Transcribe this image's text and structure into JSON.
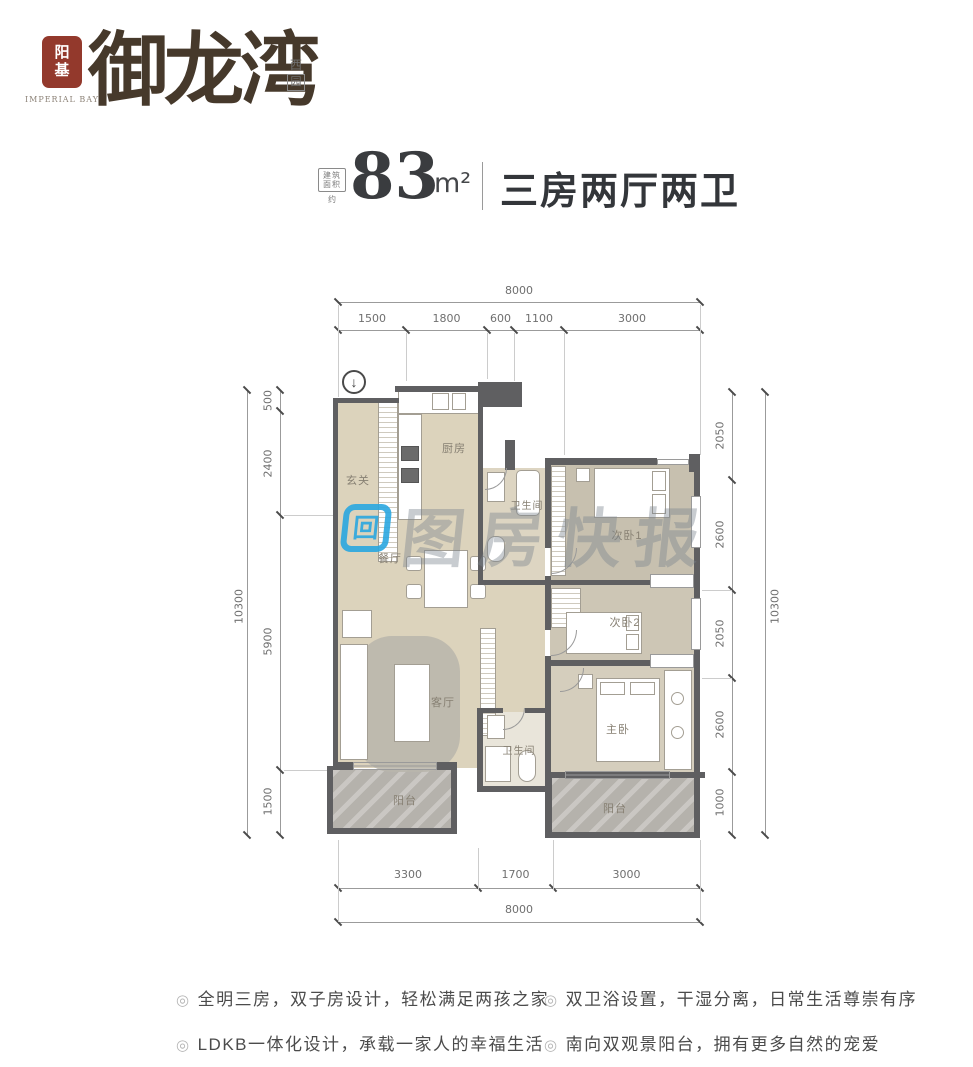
{
  "brand": {
    "seal": "阳基",
    "seal_caption": "IMPERIAL BAY",
    "name": "御龙湾",
    "badge_top": "西",
    "badge_bottom": "园"
  },
  "title": {
    "stamp_line1": "建筑",
    "stamp_line2": "面积",
    "stamp_line3": "约",
    "area": "83",
    "unit": "m²",
    "layout": "三房两厅两卫"
  },
  "plan": {
    "north": "↓",
    "rooms": {
      "hallway": "玄关",
      "kitchen": "厨房",
      "bath1": "卫生间",
      "dining": "餐厅",
      "living": "客厅",
      "bed1": "次卧1",
      "bed2": "次卧2",
      "master": "主卧",
      "bath2": "卫生间",
      "balcony1": "阳台",
      "balcony2": "阳台"
    },
    "dims": {
      "top_total": "8000",
      "top_segments": [
        "1500",
        "1800",
        "600",
        "1100",
        "3000"
      ],
      "left_total": "10300",
      "left_segments": [
        "500",
        "2400",
        "5900",
        "1500"
      ],
      "right_total": "10300",
      "right_segments": [
        "2050",
        "2600",
        "2050",
        "2600",
        "1000"
      ],
      "bottom_segments": [
        "3300",
        "1700",
        "3000"
      ],
      "bottom_total": "8000"
    }
  },
  "watermark": {
    "logo_glyph": "回",
    "text": "图房快报"
  },
  "features": {
    "bullet": "◎",
    "items": [
      "全明三房，双子房设计，轻松满足两孩之家",
      "双卫浴设置，干湿分离，日常生活尊崇有序",
      "LDKB一体化设计，承载一家人的幸福生活",
      "南向双观景阳台，拥有更多自然的宠爱"
    ]
  },
  "colors": {
    "wall": "#5f5f61",
    "floor_beige": "#dcd3bc",
    "balcony_gray": "#b5b2ac",
    "seal_red": "#93392c",
    "watermark_blue": "#2aa7e0",
    "title_dark": "#33363a"
  }
}
